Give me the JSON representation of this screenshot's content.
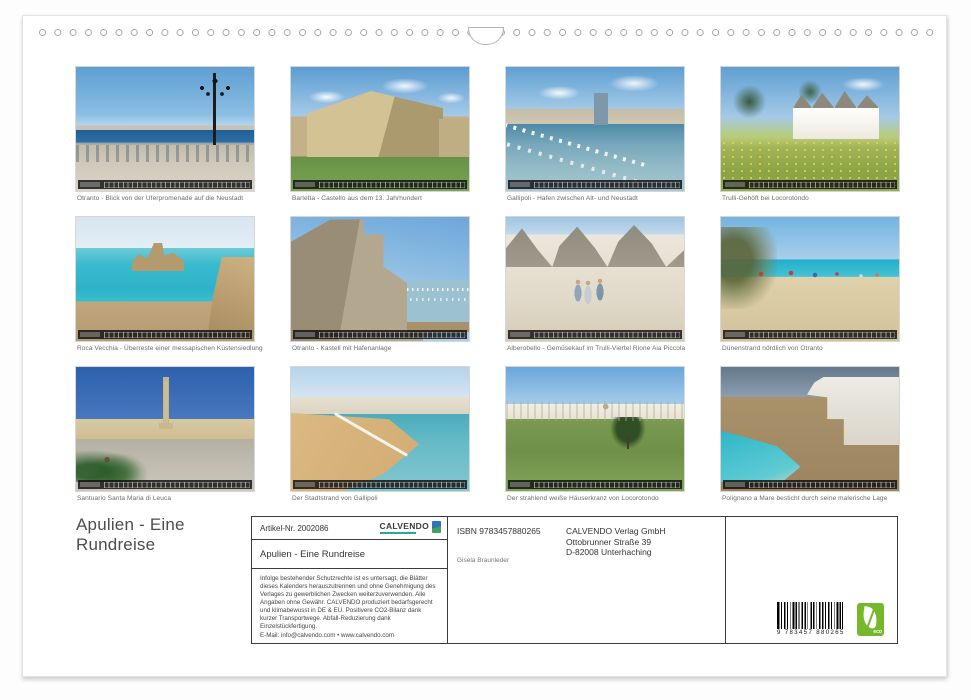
{
  "page": {
    "title_lines": [
      "Apulien - Eine",
      "Rundreise"
    ]
  },
  "photos": [
    {
      "caption": "Otranto - Blick von der Uferpromenade auf die Neustadt",
      "scene": "otranto-promenade"
    },
    {
      "caption": "Barletta - Castello aus dem 13. Jahrhundert",
      "scene": "barletta-castello"
    },
    {
      "caption": "Gallipoli - Hafen zwischen Alt- und Neustadt",
      "scene": "gallipoli-hafen"
    },
    {
      "caption": "Trulli-Gehöft bei Locorotondo",
      "scene": "trulli-gehoeft"
    },
    {
      "caption": "Roca Vecchia - Überreste einer messapischen Küstensiedlung",
      "scene": "roca-vecchia"
    },
    {
      "caption": "Otranto - Kastell mit Hafenanlage",
      "scene": "otranto-kastell"
    },
    {
      "caption": "Alberobello - Gemüsekauf im Trulli-Viertel Rione Aia Piccola",
      "scene": "alberobello-gasse"
    },
    {
      "caption": "Dünenstrand nördlich von Otranto",
      "scene": "duenenstrand"
    },
    {
      "caption": "Santuario Santa Maria di Leuca",
      "scene": "santuario-leuca"
    },
    {
      "caption": "Der Stadtstrand von Gallipoli",
      "scene": "stadtstrand-gallipoli"
    },
    {
      "caption": "Der strahlend weiße Häuserkranz von Locorotondo",
      "scene": "locorotondo-panorama"
    },
    {
      "caption": "Polignano a Mare besticht durch seine malerische Lage",
      "scene": "polignano-a-mare"
    }
  ],
  "info_box": {
    "article_label": "Artikel-Nr. 2002086",
    "brand": "CALVENDO",
    "product_title": "Apulien - Eine Rundreise",
    "legal_text": "Infolge bestehender Schutzrechte ist es untersagt, die Blätter dieses Kalenders herauszutrennen und ohne Genehmigung des Verlages zu gewerblichen Zwecken weiterzuverwenden. Alle Angaben ohne Gewähr. CALVENDO produziert bedarfsgerecht und klimabewusst in DE & EU. Positivere CO2-Bilanz dank kurzer Transportwege. Abfall-Reduzierung dank Einzelstückfertigung.",
    "email_line": "E-Mail: info@calvendo.com • www.calvendo.com",
    "isbn": "ISBN 9783457880265",
    "publisher_lines": [
      "CALVENDO Verlag GmbH",
      "Ottobrunner Straße 39",
      "D-82008 Unterhaching"
    ],
    "author": "Gisela Braunleder",
    "barcode_number": "9 783457 880265",
    "eco_label": "eco"
  },
  "colors": {
    "eco_green": "#76b82a",
    "calvendo_teal": "#2aa79b",
    "brand_dark": "#3a3a3a"
  }
}
